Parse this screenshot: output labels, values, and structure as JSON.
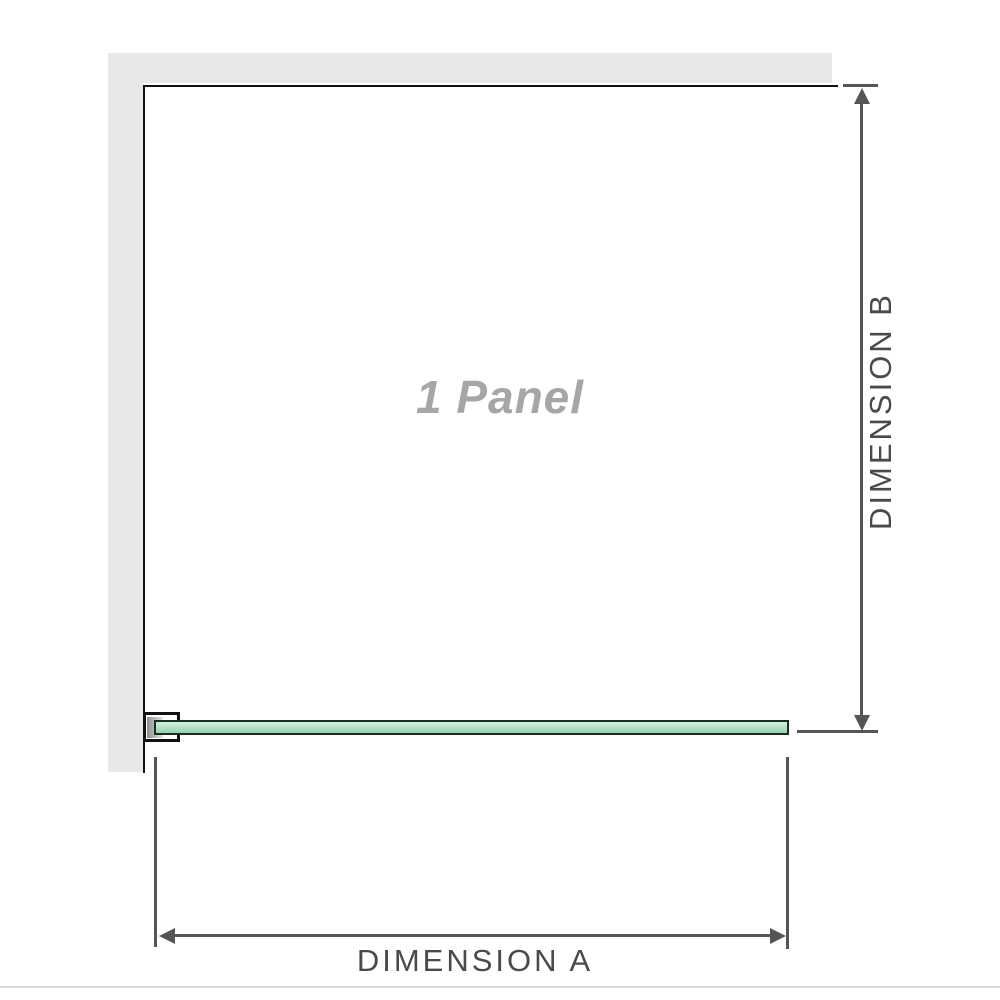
{
  "diagram": {
    "panel_label": "1 Panel",
    "dimension_a": {
      "label": "DIMENSION A",
      "orientation": "horizontal"
    },
    "dimension_b": {
      "label": "DIMENSION B",
      "orientation": "vertical"
    }
  },
  "colors": {
    "wall": "#e8e8e8",
    "edge_line": "#111111",
    "dimension_line": "#555555",
    "label_text": "#4a4a4a",
    "panel_watermark": "#a6a6a6",
    "glass_fill_light": "#d4ecdf",
    "glass_fill_dark": "#96d0ae",
    "glass_border": "#16301f",
    "divider": "#d9d9d2"
  }
}
